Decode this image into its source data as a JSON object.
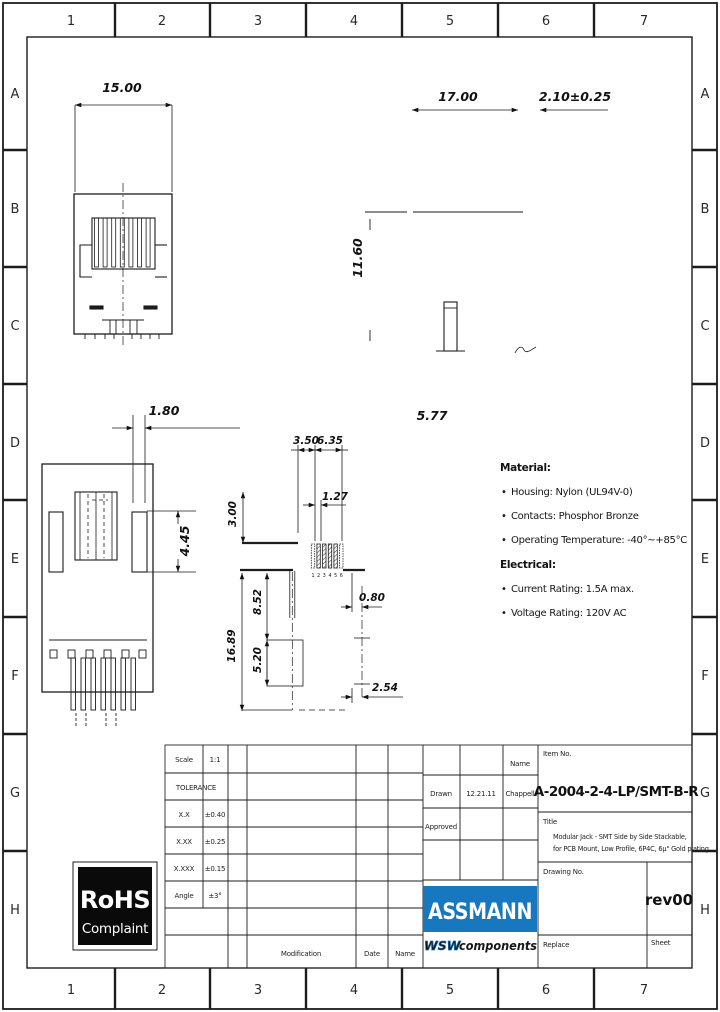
{
  "grid": {
    "cols": [
      "1",
      "2",
      "3",
      "4",
      "5",
      "6",
      "7"
    ],
    "rows": [
      "A",
      "B",
      "C",
      "D",
      "E",
      "F",
      "G",
      "H"
    ]
  },
  "dims": {
    "front_width": "15.00",
    "side_width": "17.00",
    "tab": "2.10±0.25",
    "height": "11.60",
    "post": "5.77",
    "slot": "1.80",
    "latch": "4.45",
    "pad_left": "3.50",
    "pad_span": "6.35",
    "pitch": "1.27",
    "pad_len": "3.00",
    "hole_top": "8.52",
    "total_len": "16.89",
    "hole_span": "5.20",
    "offset": "0.80",
    "hole_pitch": "2.54",
    "pad_numbers": [
      "1",
      "2",
      "3",
      "4",
      "5",
      "6"
    ]
  },
  "notes": {
    "bullet": "•",
    "material_title": "Material:",
    "material_items": [
      "Housing: Nylon (UL94V-0)",
      "Contacts: Phosphor Bronze",
      "Operating Temperature: -40°~+85°C"
    ],
    "electrical_title": "Electrical:",
    "electrical_items": [
      "Current Rating: 1.5A max.",
      "Voltage Rating: 120V AC"
    ]
  },
  "title_block": {
    "scale_label": "Scale",
    "scale_value": "1:1",
    "tolerance_label": "TOLERANCE",
    "tolerances": [
      {
        "label": "X.X",
        "value": "±0.40"
      },
      {
        "label": "X.XX",
        "value": "±0.25"
      },
      {
        "label": "X.XXX",
        "value": "±0.15"
      },
      {
        "label": "Angle",
        "value": "±3°"
      }
    ],
    "name_label": "Name",
    "drawn_label": "Drawn",
    "drawn_date": "12.21.11",
    "drawn_name": "Chappell",
    "approved_label": "Approved",
    "item_no_label": "Item No.",
    "item_no": "A-2004-2-4-LP/SMT-B-R",
    "title_label": "Title",
    "title_line1": "Modular Jack - SMT Side by Side Stackable,",
    "title_line2": "for PCB Mount, Low Profile, 6P4C, 6µ\" Gold plating",
    "drawing_no_label": "Drawing No.",
    "revision": "rev00",
    "replace_label": "Replace",
    "sheet_label": "Sheet",
    "modification_label": "Modification",
    "date_label": "Date",
    "name_label2": "Name"
  },
  "logos": {
    "rohs_line1": "RoHS",
    "rohs_line2": "Complaint",
    "assmann": "ASSMANN",
    "wsw": "WSW",
    "components": "components"
  },
  "colors": {
    "assmann_blue": "#1878bf",
    "line": "#1c1c1c"
  }
}
